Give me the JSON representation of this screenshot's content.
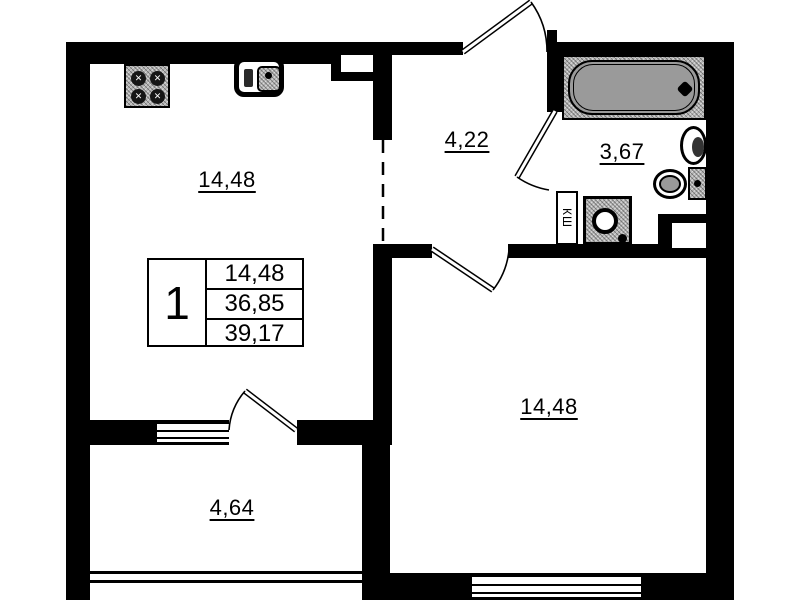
{
  "rooms": [
    {
      "name": "kitchen-living-room",
      "area": "14,48"
    },
    {
      "name": "hallway",
      "area": "4,22"
    },
    {
      "name": "bathroom",
      "area": "3,67"
    },
    {
      "name": "bedroom",
      "area": "14,48"
    },
    {
      "name": "balcony",
      "area": "4,64"
    }
  ],
  "legend": {
    "apartment_number": "1",
    "rows": [
      "14,48",
      "36,85",
      "39,17"
    ]
  },
  "duct_label": "КШ",
  "fixtures": [
    "stove",
    "kitchen-sink",
    "bathtub",
    "washbasin",
    "toilet",
    "washing-machine"
  ],
  "colors": {
    "wall": "#000000",
    "fixture_gray": "#9a9a9a",
    "background": "#ffffff"
  }
}
